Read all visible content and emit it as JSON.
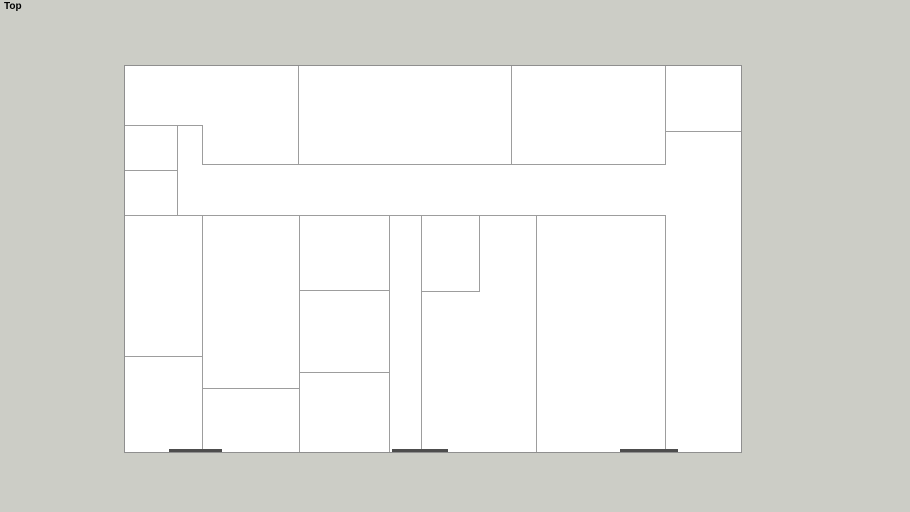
{
  "viewport": {
    "app_context": "3d-modeler-top-view",
    "view_label": "Top",
    "background_color": "#cccdc6",
    "label_color": "#000000"
  },
  "plan": {
    "fill_color": "#ffffff",
    "line_color": "#9d9d9d",
    "outline_color": "#8f8f8f",
    "thick_edge_color": "#4d4d4d",
    "bounds": {
      "left": 124,
      "top": 65,
      "width": 616,
      "height": 386
    },
    "walls": [
      {
        "x": 173,
        "y": 0,
        "w": 1,
        "h": 98
      },
      {
        "x": 386,
        "y": 0,
        "w": 1,
        "h": 98
      },
      {
        "x": 540,
        "y": 0,
        "w": 1,
        "h": 98
      },
      {
        "x": 77,
        "y": 59,
        "w": 1,
        "h": 40
      },
      {
        "x": 52,
        "y": 59,
        "w": 1,
        "h": 90
      },
      {
        "x": 0,
        "y": 59,
        "w": 77,
        "h": 1
      },
      {
        "x": 540,
        "y": 65,
        "w": 76,
        "h": 1
      },
      {
        "x": 77,
        "y": 98,
        "w": 464,
        "h": 1
      },
      {
        "x": 0,
        "y": 104,
        "w": 53,
        "h": 1
      },
      {
        "x": 0,
        "y": 149,
        "w": 541,
        "h": 1
      },
      {
        "x": 77,
        "y": 149,
        "w": 1,
        "h": 237
      },
      {
        "x": 174,
        "y": 149,
        "w": 1,
        "h": 237
      },
      {
        "x": 264,
        "y": 149,
        "w": 1,
        "h": 237
      },
      {
        "x": 296,
        "y": 149,
        "w": 1,
        "h": 237
      },
      {
        "x": 354,
        "y": 149,
        "w": 1,
        "h": 76
      },
      {
        "x": 411,
        "y": 149,
        "w": 1,
        "h": 237
      },
      {
        "x": 540,
        "y": 149,
        "w": 1,
        "h": 237
      },
      {
        "x": 174,
        "y": 224,
        "w": 91,
        "h": 1
      },
      {
        "x": 296,
        "y": 225,
        "w": 59,
        "h": 1
      },
      {
        "x": 0,
        "y": 290,
        "w": 78,
        "h": 1
      },
      {
        "x": 174,
        "y": 306,
        "w": 91,
        "h": 1
      },
      {
        "x": 77,
        "y": 322,
        "w": 98,
        "h": 1
      }
    ],
    "thick_edges": [
      {
        "x": 44,
        "y": 383,
        "w": 53,
        "h": 3
      },
      {
        "x": 267,
        "y": 383,
        "w": 56,
        "h": 3
      },
      {
        "x": 495,
        "y": 383,
        "w": 58,
        "h": 3
      }
    ]
  }
}
